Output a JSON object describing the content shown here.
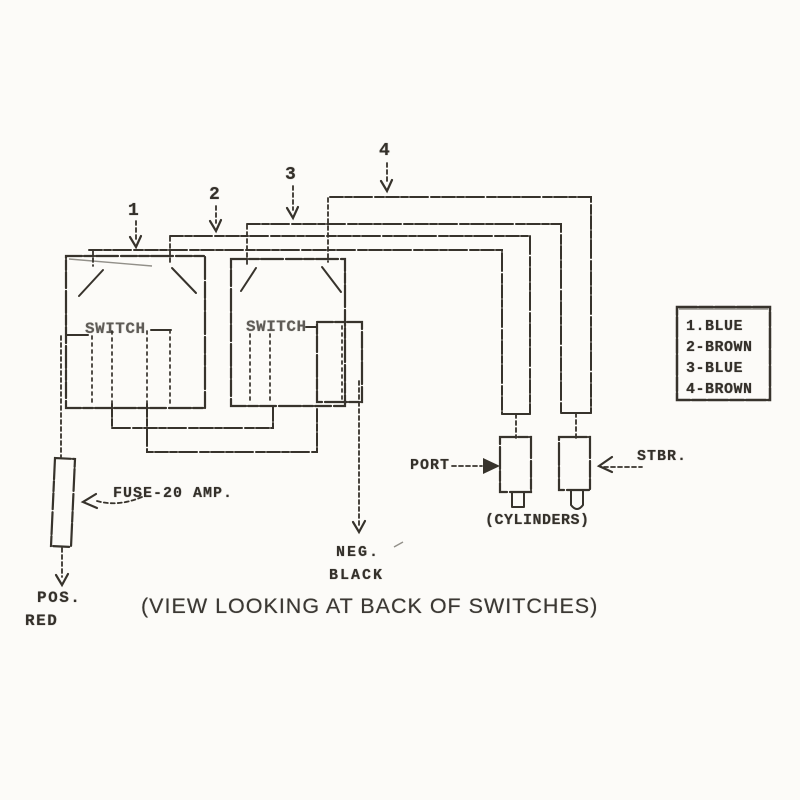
{
  "colors": {
    "ink": "#37332c",
    "paper": "#fcfbf8"
  },
  "top_wires": {
    "numbers": [
      "1",
      "2",
      "3",
      "4"
    ]
  },
  "switch_panel": {
    "switch1_label": "SWITCH",
    "switch2_label": "SWITCH"
  },
  "fuse": {
    "label": "FUSE-20 AMP."
  },
  "power": {
    "pos_label": "POS.",
    "pos_wire": "RED",
    "neg_label": "NEG.",
    "neg_wire": "BLACK"
  },
  "cylinders": {
    "port_label": "PORT",
    "stbr_label": "STBR.",
    "group_label": "(CYLINDERS)"
  },
  "legend": {
    "items": [
      {
        "label": "1.BLUE"
      },
      {
        "label": "2-BROWN"
      },
      {
        "label": "3-BLUE"
      },
      {
        "label": "4-BROWN"
      }
    ]
  },
  "caption": {
    "text": "(VIEW LOOKING AT BACK OF SWITCHES)"
  }
}
